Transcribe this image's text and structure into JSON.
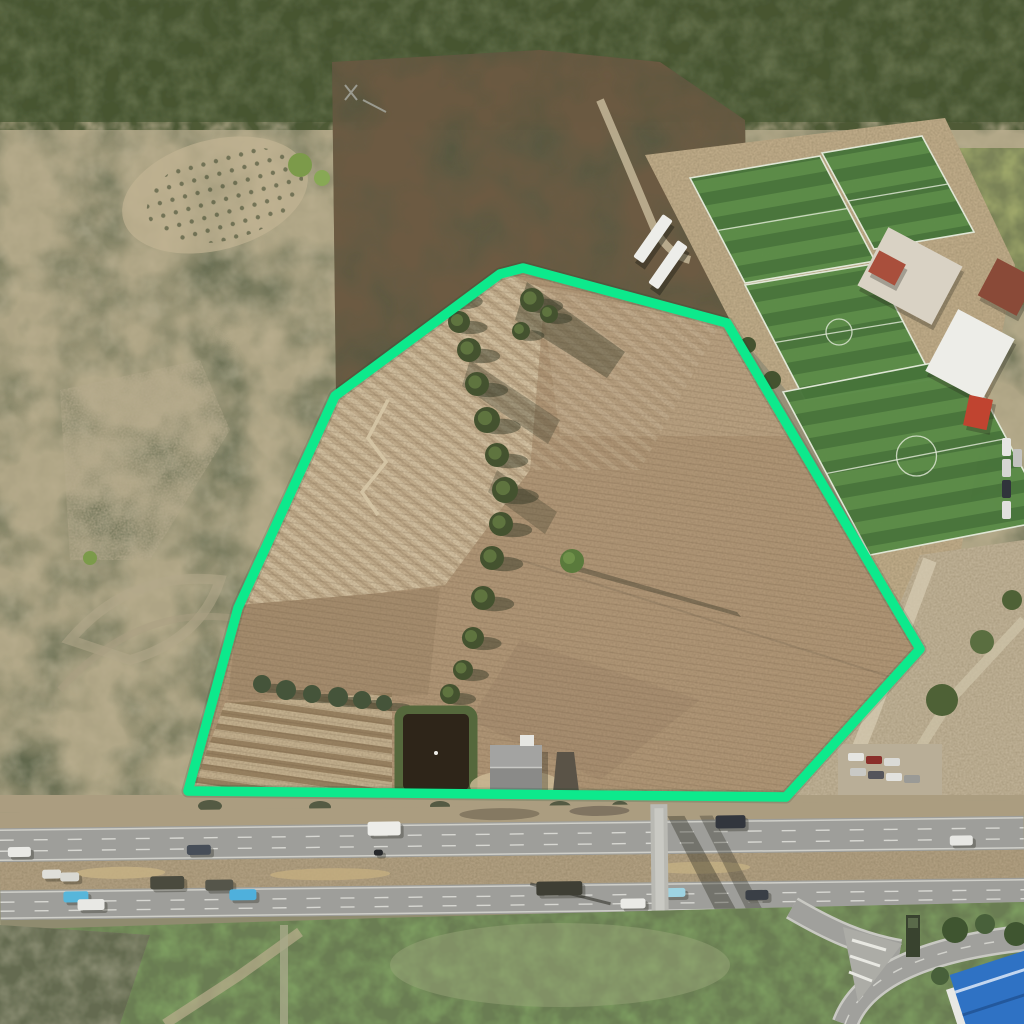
{
  "scene": {
    "type": "aerial_drone_photograph",
    "description": "Aerial drone photo of a farmland parcel outlined with a bright green boundary, bordered by a football training complex, scrubland hills and a multi-lane highway with traffic"
  },
  "canvas": {
    "width": 1024,
    "height": 1024
  },
  "palette": {
    "boundary": "#0DE98C",
    "scrub_base": "#8F9076",
    "scrub_dark": "#5A6247",
    "scrub_tan": "#C2B493",
    "scrub_burnt": "#57563F",
    "trees_top": "#5C6A45",
    "trees_dark": "#44522F",
    "field": "#B29878",
    "field_light": "#C8B392",
    "field_mid": "#A78E6F",
    "dirt": "#C2AE8B",
    "water": "#2E2519",
    "veg_rim": "#55683C",
    "pitch_dark": "#47743A",
    "pitch_light": "#5A8B47",
    "pitch_line": "#E3EAD9",
    "road": "#9E9E9A",
    "median": "#B4A284",
    "verge": "#AB9D80",
    "grass": "#7FA062",
    "white_roof": "#EDEDE8",
    "roof_red": "#A94F3C",
    "roof_blue": "#2F72C4",
    "shadow": "rgba(45,50,33,0.45)"
  },
  "parcel": {
    "boundary_points": "188,791 238,608 335,396 500,274 523,268 727,323 920,649 786,797",
    "boundary_stroke_width": 9.5,
    "tree_line": [
      [
        449,
        295,
        13
      ],
      [
        459,
        322,
        11
      ],
      [
        469,
        350,
        12
      ],
      [
        477,
        384,
        12
      ],
      [
        487,
        420,
        13
      ],
      [
        497,
        455,
        12
      ],
      [
        505,
        490,
        13
      ],
      [
        501,
        524,
        12
      ],
      [
        492,
        558,
        12
      ],
      [
        483,
        598,
        12
      ],
      [
        473,
        638,
        11
      ],
      [
        463,
        670,
        10
      ],
      [
        450,
        694,
        10
      ],
      [
        532,
        300,
        12
      ],
      [
        549,
        314,
        9
      ],
      [
        521,
        331,
        9
      ]
    ],
    "bush_row": [
      [
        262,
        684,
        9
      ],
      [
        286,
        690,
        10
      ],
      [
        312,
        694,
        9
      ],
      [
        338,
        697,
        10
      ],
      [
        362,
        700,
        9
      ],
      [
        384,
        703,
        8
      ]
    ],
    "track_points": "388,400 368,438 386,462 362,492 378,515",
    "lone_tree": {
      "x": 572,
      "y": 561,
      "r": 12,
      "shadow_to": [
        737,
        614
      ]
    },
    "pond": {
      "x": 403,
      "y": 714,
      "w": 66,
      "h": 76
    },
    "pond_bird": {
      "x": 436,
      "y": 753
    },
    "house": {
      "x": 490,
      "y": 745,
      "w": 52,
      "h": 45
    },
    "water_tower": {
      "points": "557,752 574,752 579,792 553,792"
    }
  },
  "sports_complex": {
    "pitches": [
      {
        "points": "690,178 820,156 875,261 745,283",
        "center_circle_r": 0
      },
      {
        "points": "822,153 922,136 974,232 874,249",
        "center_circle_r": 0
      },
      {
        "points": "745,285 873,264 933,379 805,400",
        "center_circle_r": 13
      },
      {
        "points": "783,392 963,357 1050,520 870,555",
        "center_circle_r": 20
      }
    ],
    "buildings": [
      {
        "name": "clubhouse-compound",
        "x": 868,
        "y": 243,
        "w": 84,
        "h": 66,
        "rot": 28,
        "color": "#D9D2C4"
      },
      {
        "name": "red-roof-house",
        "x": 872,
        "y": 256,
        "w": 30,
        "h": 24,
        "rot": 28,
        "color": "#A94F3C"
      },
      {
        "name": "white-warehouse",
        "x": 938,
        "y": 320,
        "w": 64,
        "h": 70,
        "rot": 28,
        "color": "#EDEDE8"
      },
      {
        "name": "orange-roof-house",
        "x": 985,
        "y": 266,
        "w": 44,
        "h": 42,
        "rot": 28,
        "color": "#8A4A38"
      },
      {
        "name": "red-truck",
        "x": 966,
        "y": 397,
        "w": 24,
        "h": 31,
        "rot": 12,
        "color": "#C04430"
      }
    ],
    "trailers": [
      {
        "x": 663,
        "y": 214,
        "w": 12,
        "h": 52,
        "rot": 35
      },
      {
        "x": 678,
        "y": 240,
        "w": 12,
        "h": 52,
        "rot": 35
      }
    ],
    "parked_cars_east": [
      [
        1002,
        438,
        "#E6E6E2"
      ],
      [
        1002,
        459,
        "#D6D6D2"
      ],
      [
        1002,
        480,
        "#30343B"
      ],
      [
        1002,
        501,
        "#E0E0DC"
      ],
      [
        1013,
        449,
        "#C2C2BE"
      ]
    ]
  },
  "roadside": {
    "parking_lot_cars": [
      [
        848,
        753,
        "#E5E5E1"
      ],
      [
        866,
        756,
        "#8A2F2A"
      ],
      [
        884,
        758,
        "#DADAD6"
      ],
      [
        850,
        768,
        "#C9C9C5"
      ],
      [
        868,
        771,
        "#55555B"
      ],
      [
        886,
        773,
        "#E2E2DE"
      ],
      [
        904,
        775,
        "#9A9A96"
      ]
    ],
    "sign": {
      "x": 906,
      "y": 915,
      "w": 14,
      "h": 42
    }
  },
  "highway": {
    "tilt_deg": -0.7,
    "footbridge": {
      "x": 651,
      "y": 806,
      "w": 17,
      "h": 132
    },
    "vehicles": [
      [
        8,
        841,
        23,
        10,
        "#E9E9E5"
      ],
      [
        187,
        841,
        24,
        10,
        "#474E58"
      ],
      [
        368,
        820,
        33,
        14,
        "#EDEDE9"
      ],
      [
        716,
        818,
        30,
        13,
        "#32363D"
      ],
      [
        950,
        841,
        23,
        10,
        "#E7E7E3"
      ],
      [
        374,
        848,
        9,
        6,
        "#26282B"
      ],
      [
        42,
        864,
        19,
        9,
        "#DFDFD9"
      ],
      [
        60,
        867,
        19,
        9,
        "#D8D8D2"
      ],
      [
        150,
        872,
        34,
        13,
        "#4A4A3E"
      ],
      [
        205,
        876,
        28,
        11,
        "#55554A"
      ],
      [
        63,
        886,
        25,
        11,
        "#57B6DA"
      ],
      [
        77,
        894,
        27,
        11,
        "#E8E8E4"
      ],
      [
        229,
        886,
        27,
        11,
        "#4FB0DC"
      ],
      [
        536,
        882,
        46,
        14,
        "#3E3E34"
      ],
      [
        620,
        900,
        25,
        10,
        "#EAEAE6"
      ],
      [
        664,
        890,
        21,
        9,
        "#9ED3E2"
      ],
      [
        745,
        893,
        23,
        10,
        "#3A3F46"
      ],
      [
        866,
        916,
        12,
        17,
        "#3A6FB5"
      ],
      [
        877,
        927,
        11,
        15,
        "#4478BE"
      ]
    ]
  }
}
